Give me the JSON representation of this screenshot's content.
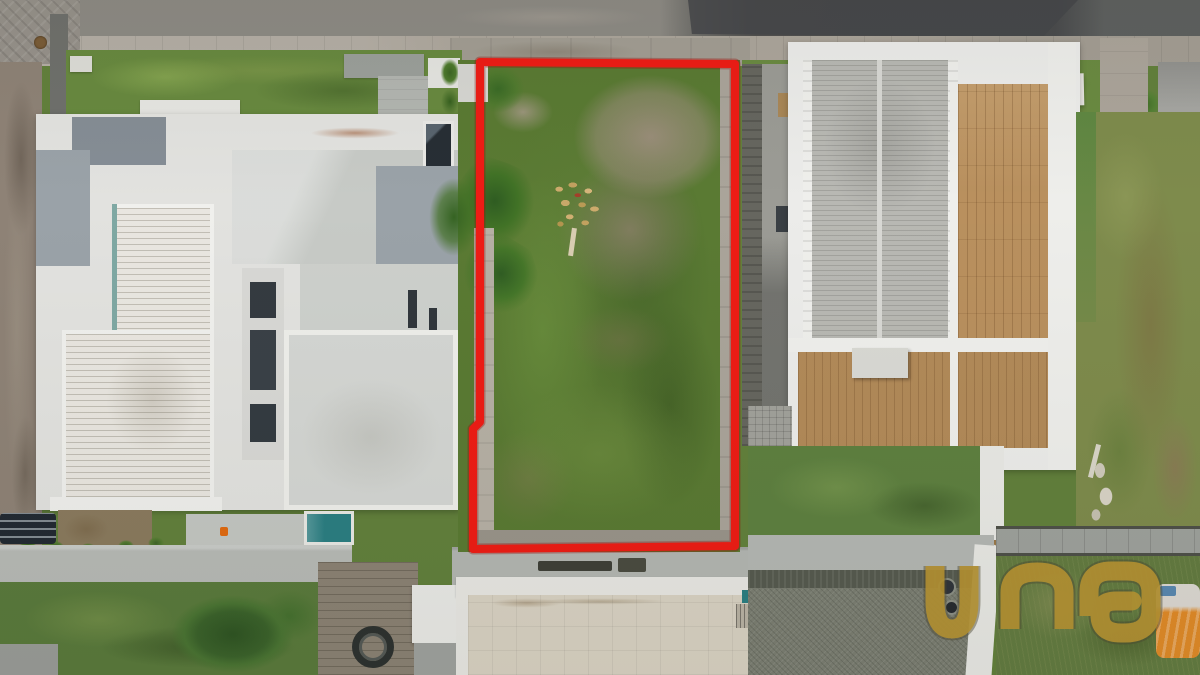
{
  "watermark": {
    "text": "una",
    "color": "#bc9733"
  },
  "lot_outline": {
    "color": "#ee1c15"
  }
}
